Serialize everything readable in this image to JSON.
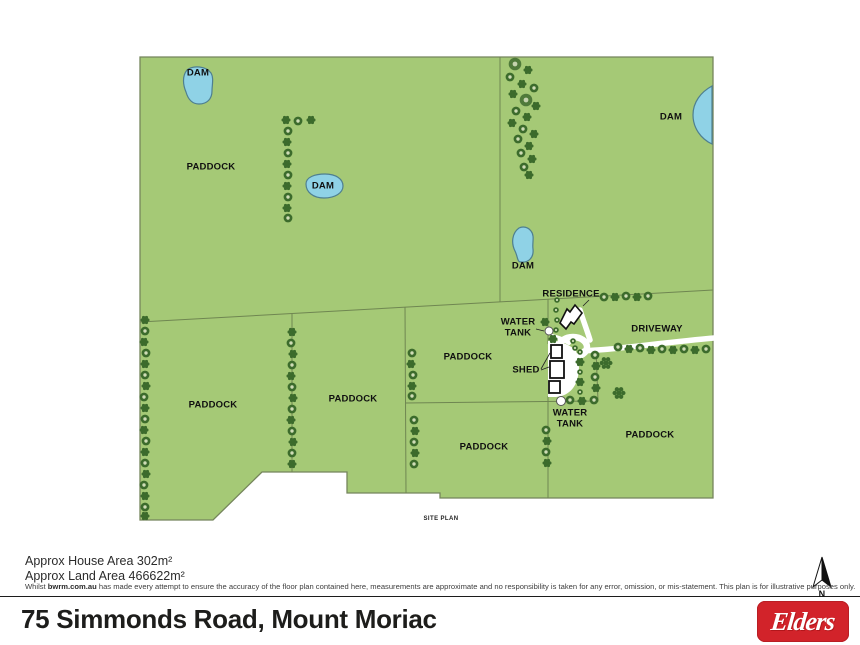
{
  "map": {
    "labels": {
      "dam_nw": "DAM",
      "dam_w": "DAM",
      "dam_ne": "DAM",
      "dam_c": "DAM",
      "paddock_nw": "PADDOCK",
      "paddock_w": "PADDOCK",
      "paddock_sw": "PADDOCK",
      "paddock_c": "PADDOCK",
      "paddock_s": "PADDOCK",
      "paddock_se": "PADDOCK",
      "residence": "RESIDENCE",
      "water_tank_north": "WATER TANK",
      "water_tank_south": "WATER TANK",
      "shed": "SHED",
      "driveway": "DRIVEWAY",
      "site_plan": "SITE PLAN",
      "north": "N"
    },
    "colors": {
      "land": "#a5c976",
      "boundary": "#75855c",
      "dam_fill": "#8fd2e6",
      "dam_stroke": "#4e7f90",
      "tree": "#3c6b2c",
      "driveway": "#ffffff"
    }
  },
  "footer": {
    "house_area": "Approx House Area 302m²",
    "land_area": "Approx Land Area 466622m²",
    "disclaimer_prefix": "Whilst ",
    "disclaimer_brand": "bwrm.com.au",
    "disclaimer_rest": " has made every attempt to ensure the accuracy of the floor plan contained here, measurements are approximate and no responsibility is taken for any error, omission, or mis-statement. This plan is for illustrative purposes only.",
    "title": "75 Simmonds Road, Mount Moriac",
    "brand": "Elders"
  }
}
